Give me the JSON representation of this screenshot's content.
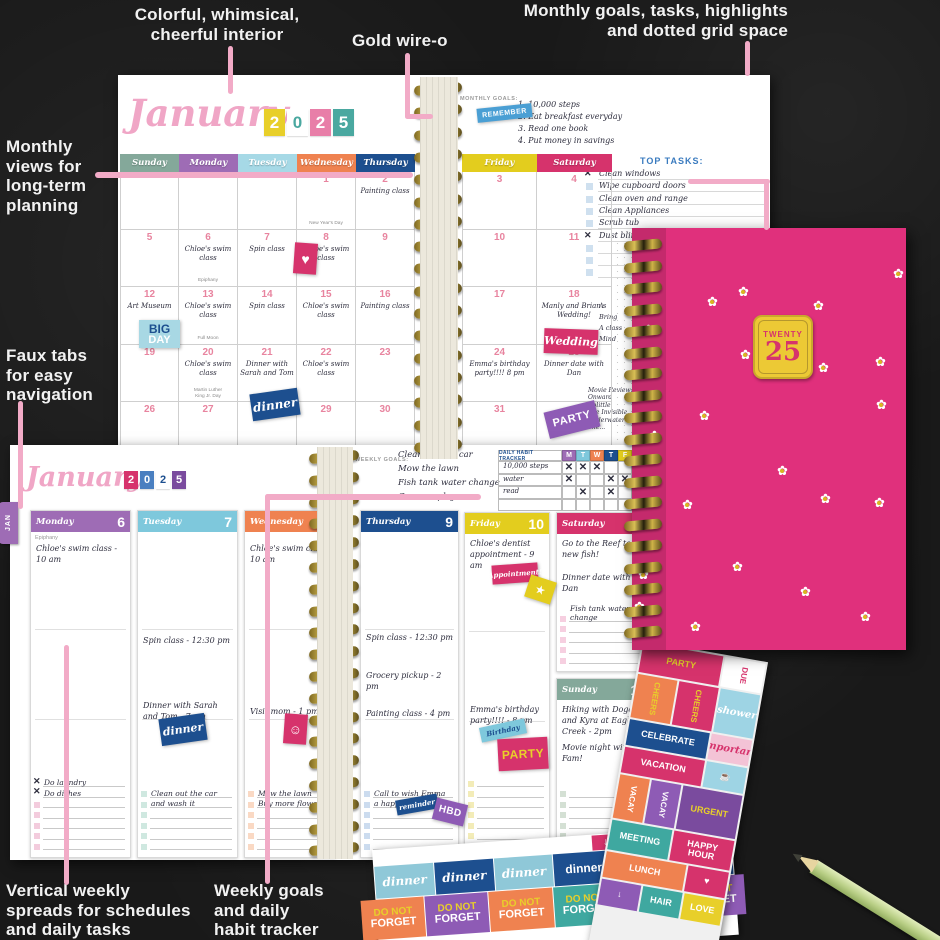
{
  "annotations": {
    "interior": "Colorful, whimsical,\ncheerful interior",
    "wire": "Gold wire-o",
    "monthly_goals": "Monthly goals, tasks, highlights\nand dotted grid space",
    "monthly_views": "Monthly\nviews for\nlong-term\nplanning",
    "faux_tabs": "Faux tabs\nfor easy\nnavigation",
    "weekly_spreads": "Vertical weekly\nspreads for schedules\nand daily tasks",
    "weekly_goals": "Weekly goals\nand daily\nhabit tracker"
  },
  "monthly": {
    "title": "January",
    "year": [
      {
        "d": "2",
        "bg": "#e8cf2a",
        "fg": "#ffffff"
      },
      {
        "d": "0",
        "bg": "#ffffff",
        "fg": "#4aa8a0"
      },
      {
        "d": "2",
        "bg": "#e87ea8",
        "fg": "#ffffff"
      },
      {
        "d": "5",
        "bg": "#4aa8a0",
        "fg": "#ffffff"
      }
    ],
    "goals_label": "MONTHLY GOALS:",
    "goals": [
      "1. 10,000 steps",
      "2. Eat breakfast everyday",
      "3. Read one book",
      "4. Put money in savings"
    ],
    "top_tasks_label": "TOP TASKS:",
    "top_tasks": [
      {
        "t": "Clean windows",
        "x": true
      },
      {
        "t": "Wipe cupboard doors"
      },
      {
        "t": "Clean oven and range"
      },
      {
        "t": "Clean Appliances"
      },
      {
        "t": "Scrub tub"
      },
      {
        "t": "Dust blinds",
        "x": true
      },
      {},
      {},
      {}
    ],
    "side_notes": [
      "A",
      "Bring",
      "A class",
      "Mind"
    ],
    "movies": [
      "Movie Review:",
      "Onward",
      "Dolittle",
      "The Invisible...",
      "Underwater",
      "The..."
    ],
    "weekdays": [
      {
        "label": "Sunday",
        "color": "#84a89a"
      },
      {
        "label": "Monday",
        "color": "#9e6cb5"
      },
      {
        "label": "Tuesday",
        "color": "#a6d9e6"
      },
      {
        "label": "Wednesday",
        "color": "#ef8250"
      },
      {
        "label": "Thursday",
        "color": "#1d4f8f"
      },
      {
        "label": "Friday",
        "color": "#e3cd1e"
      },
      {
        "label": "Saturday",
        "color": "#d6336c"
      }
    ],
    "weeks": [
      [
        null,
        null,
        null,
        {
          "d": "1",
          "sub": "New Year's Day"
        },
        {
          "d": "2",
          "t": "Painting class"
        },
        {
          "d": "3"
        },
        {
          "d": "4"
        }
      ],
      [
        {
          "d": "5"
        },
        {
          "d": "6",
          "t": "Chloe's swim class",
          "sub": "Epiphany"
        },
        {
          "d": "7",
          "t": "Spin class"
        },
        {
          "d": "8",
          "t": "Chloe's swim class"
        },
        {
          "d": "9"
        },
        {
          "d": "10"
        },
        {
          "d": "11"
        }
      ],
      [
        {
          "d": "12",
          "t": "Art Museum"
        },
        {
          "d": "13",
          "t": "Chloe's swim class",
          "sub": "Full Moon"
        },
        {
          "d": "14",
          "t": "Spin class"
        },
        {
          "d": "15",
          "t": "Chloe's swim class"
        },
        {
          "d": "16",
          "t": "Painting class"
        },
        {
          "d": "17"
        },
        {
          "d": "18",
          "t": "Manly and Brian's Wedding!"
        }
      ],
      [
        {
          "d": "19"
        },
        {
          "d": "20",
          "t": "Chloe's swim class",
          "sub": "Martin Luther\nKing Jr. Day"
        },
        {
          "d": "21",
          "t": "Dinner with Sarah and Tom"
        },
        {
          "d": "22",
          "t": "Chloe's swim class"
        },
        {
          "d": "23"
        },
        {
          "d": "24",
          "t": "Emma's birthday party!!!! 8 pm"
        },
        {
          "d": "25",
          "t": "Dinner date with Dan"
        }
      ],
      [
        {
          "d": "26"
        },
        {
          "d": "27"
        },
        {
          "d": "28"
        },
        {
          "d": "29"
        },
        {
          "d": "30"
        },
        {
          "d": "31"
        },
        null
      ]
    ]
  },
  "weekly": {
    "title": "January",
    "year": [
      {
        "d": "2",
        "bg": "#d6336c",
        "fg": "#ffffff"
      },
      {
        "d": "0",
        "bg": "#4a7fc0",
        "fg": "#ffffff"
      },
      {
        "d": "2",
        "bg": "#ffffff",
        "fg": "#1d4f8f"
      },
      {
        "d": "5",
        "bg": "#7a4b9e",
        "fg": "#ffffff"
      }
    ],
    "tab": "JAN",
    "goals_label": "WEEKLY GOALS:",
    "goals": [
      "Clean out the car",
      "Mow the lawn",
      "Fish tank water change",
      "Go see a play"
    ],
    "tracker": {
      "label": "DAILY HABIT TRACKER",
      "days": [
        {
          "l": "M",
          "bg": "#9e6cb5"
        },
        {
          "l": "T",
          "bg": "#7ec8dc"
        },
        {
          "l": "W",
          "bg": "#ef8250"
        },
        {
          "l": "T",
          "bg": "#1d4f8f"
        },
        {
          "l": "F",
          "bg": "#e3cd1e"
        }
      ],
      "rows": [
        {
          "t": "10,000 steps",
          "m": [
            1,
            1,
            1,
            0,
            0
          ]
        },
        {
          "t": "water",
          "m": [
            1,
            0,
            0,
            1,
            1
          ]
        },
        {
          "t": "read",
          "m": [
            0,
            1,
            0,
            1,
            0
          ]
        }
      ]
    },
    "days": [
      {
        "name": "Monday",
        "num": "6",
        "color": "#9e6cb5",
        "sq": "#f3ccdd",
        "sub": "Epiphany",
        "entries": [
          {
            "t": "Chloe's swim class - 10 am",
            "dy": 33
          }
        ],
        "checks": [
          {
            "t": "Do laundry",
            "x": true
          },
          {
            "t": "Do dishes",
            "x": true
          },
          {},
          {},
          {},
          {},
          {}
        ]
      },
      {
        "name": "Tuesday",
        "num": "7",
        "color": "#7ec8dc",
        "sq": "#cfe8e0",
        "entries": [
          {
            "t": "Spin class - 12:30 pm",
            "dy": 125
          },
          {
            "t": "Dinner with Sarah and Tom - 7 pm",
            "dy": 190
          }
        ],
        "checks": [
          {
            "t": "Clean out the car"
          },
          {
            "t": "and wash it"
          },
          {},
          {},
          {},
          {}
        ]
      },
      {
        "name": "Wednesday",
        "num": "8",
        "color": "#ef8250",
        "sq": "#fad9c4",
        "entries": [
          {
            "t": "Chloe's swim class - 10 am",
            "dy": 33
          },
          {
            "t": "Visit mom - 1 pm",
            "dy": 196
          }
        ],
        "checks": [
          {
            "t": "Mow the lawn"
          },
          {
            "t": "Buy more flowers"
          },
          {},
          {},
          {},
          {}
        ]
      },
      {
        "name": "Thursday",
        "num": "9",
        "color": "#1d4f8f",
        "sq": "#ccdcef",
        "entries": [
          {
            "t": "Spin class - 12:30 pm",
            "dy": 122
          },
          {
            "t": "Grocery pickup - 2 pm",
            "dy": 160
          },
          {
            "t": "Painting class - 4 pm",
            "dy": 198
          }
        ],
        "checks": [
          {
            "t": "Call to wish Emma"
          },
          {
            "t": "a happy birthday!"
          },
          {},
          {},
          {},
          {}
        ]
      },
      {
        "name": "Friday",
        "num": "10",
        "color": "#e3cd1e",
        "sq": "#f3ecb8",
        "entries": [
          {
            "t": "Chloe's dentist appointment - 9 am",
            "dy": 26
          },
          {
            "t": "Emma's birthday party!!!! - 8 pm",
            "dy": 192
          }
        ],
        "checks": [
          {},
          {},
          {},
          {},
          {},
          {},
          {}
        ]
      },
      {
        "name": "Saturday",
        "num": "11",
        "color": "#d6336c",
        "sq": "#f6cfe0",
        "entries": [
          {
            "t": "Go to the Reef to get new fish!",
            "dy": 26
          },
          {
            "t": "Dinner date with Dan",
            "dy": 60
          }
        ],
        "checks": [
          {
            "t": "Fish tank water change"
          },
          {},
          {},
          {},
          {}
        ]
      },
      {
        "name": "Sunday",
        "num": "12",
        "color": "#84a89a",
        "sq": "#d4e0d4",
        "entries": [
          {
            "t": "Hiking with Dogan and Kyra at Eagle Creek - 2pm",
            "dy": 26
          },
          {
            "t": "Movie night with the Fam!",
            "dy": 64
          }
        ],
        "checks": [
          {},
          {},
          {},
          {},
          {},
          {}
        ]
      }
    ],
    "footer": "tfpublishing.com"
  },
  "cover": {
    "badge_top": "TWENTY",
    "badge_num": "25"
  },
  "stickers": {
    "placed": {
      "remember": "REMEMBER",
      "heart": "♥",
      "bigday1": "BIG",
      "bigday2": "DAY",
      "dinner_m": "dinner",
      "wedding": "Wedding",
      "party_m": "PARTY",
      "dinner_w": "dinner",
      "smiley": "☺",
      "reminder": "reminder",
      "hbd": "HBD",
      "appt": "Appointment!",
      "star": "★",
      "birthday": "Birthday",
      "party_w": "PARTY"
    },
    "sheet_rows": [
      [
        {
          "t": "PARTY",
          "bg": "#d6336c",
          "fg": "#e8cf2a",
          "w": 2
        },
        {
          "t": "DUE",
          "bg": "#ffffff",
          "fg": "#d6336c",
          "v": 1
        }
      ],
      [
        {
          "t": "CHEERS",
          "bg": "#ef8250",
          "fg": "#e8cf2a",
          "v": 1
        },
        {
          "t": "CHEERS",
          "bg": "#d6336c",
          "fg": "#e8cf2a",
          "v": 1
        },
        {
          "t": "shower",
          "bg": "#9ed4e4",
          "fg": "#ffffff",
          "s": 1
        }
      ],
      [
        {
          "t": "CELEBRATE",
          "bg": "#1d4f8f",
          "fg": "#ffffff",
          "w": 2
        },
        {
          "t": "important",
          "bg": "#f3c3d6",
          "fg": "#d6336c",
          "s": 1
        }
      ],
      [
        {
          "t": "VACATION",
          "bg": "#d6336c",
          "fg": "#ffffff",
          "w": 2
        },
        {
          "t": "☕",
          "bg": "#9ed4e4",
          "fg": "#ffffff"
        }
      ],
      [
        {
          "t": "VACAY",
          "bg": "#ef8250",
          "fg": "#ffffff",
          "v": 1
        },
        {
          "t": "VACAY",
          "bg": "#8e5bb5",
          "fg": "#ffffff",
          "v": 1
        },
        {
          "t": "URGENT",
          "bg": "#7a4b9e",
          "fg": "#e8cf2a",
          "w": 2
        }
      ],
      [
        {
          "t": "MEETING",
          "bg": "#3fa8a0",
          "fg": "#ffffff"
        },
        {
          "t": "HAPPY\nHOUR",
          "bg": "#d6336c",
          "fg": "#ffffff"
        }
      ],
      [
        {
          "t": "LUNCH",
          "bg": "#ef8250",
          "fg": "#ffffff",
          "w": 2
        },
        {
          "t": "♥",
          "bg": "#d6336c",
          "fg": "#ffffff"
        }
      ],
      [
        {
          "t": "↓",
          "bg": "#8e5bb5",
          "fg": "#ffffff"
        },
        {
          "t": "HAIR",
          "bg": "#3fa8a0",
          "fg": "#ffffff"
        },
        {
          "t": "LOVE",
          "bg": "#e8cf2a",
          "fg": "#ffffff"
        }
      ]
    ],
    "strip": {
      "arrows": [
        {
          "t": "↓",
          "bg": "#d6336c"
        },
        {
          "t": "↓",
          "bg": "#b02355"
        },
        {
          "t": "♥",
          "bg": "#d6336c"
        },
        {
          "t": "↓",
          "bg": "#b02355"
        },
        {
          "t": "↓",
          "bg": "#d6336c"
        }
      ],
      "dinner": [
        {
          "t": "dinner",
          "bg": "#8fc8d8",
          "fg": "#ffffff",
          "s": "script"
        },
        {
          "t": "dinner",
          "bg": "#1d4f8f",
          "fg": "#ffffff",
          "s": "script"
        },
        {
          "t": "dinner",
          "bg": "#8fc8d8",
          "fg": "#ffffff",
          "s": "script"
        },
        {
          "t": "dinner",
          "bg": "#1d4f8f",
          "fg": "#ffffff",
          "s": "bold"
        },
        {
          "t": "dinner",
          "bg": "#5bb8c0",
          "fg": "#1d4f8f",
          "s": "bold"
        },
        {
          "t": "dinner",
          "bg": "#1d4f8f",
          "fg": "#ffffff",
          "s": "bold"
        }
      ],
      "forget": {
        "top": "DO NOT",
        "bottom": "FORGET",
        "top_fg": "#e8cf2a",
        "bottom_fg": "#ffffff",
        "tiles": [
          "#ef8250",
          "#8e5bb5",
          "#ef8250",
          "#3fa8a0",
          "#ef8250",
          "#8e5bb5"
        ]
      }
    }
  },
  "colors": {
    "annotation_line": "#f2abc7",
    "cover_pink": "#e0307c",
    "badge_yellow": "#ecc935",
    "badge_text": "#d6336c"
  }
}
